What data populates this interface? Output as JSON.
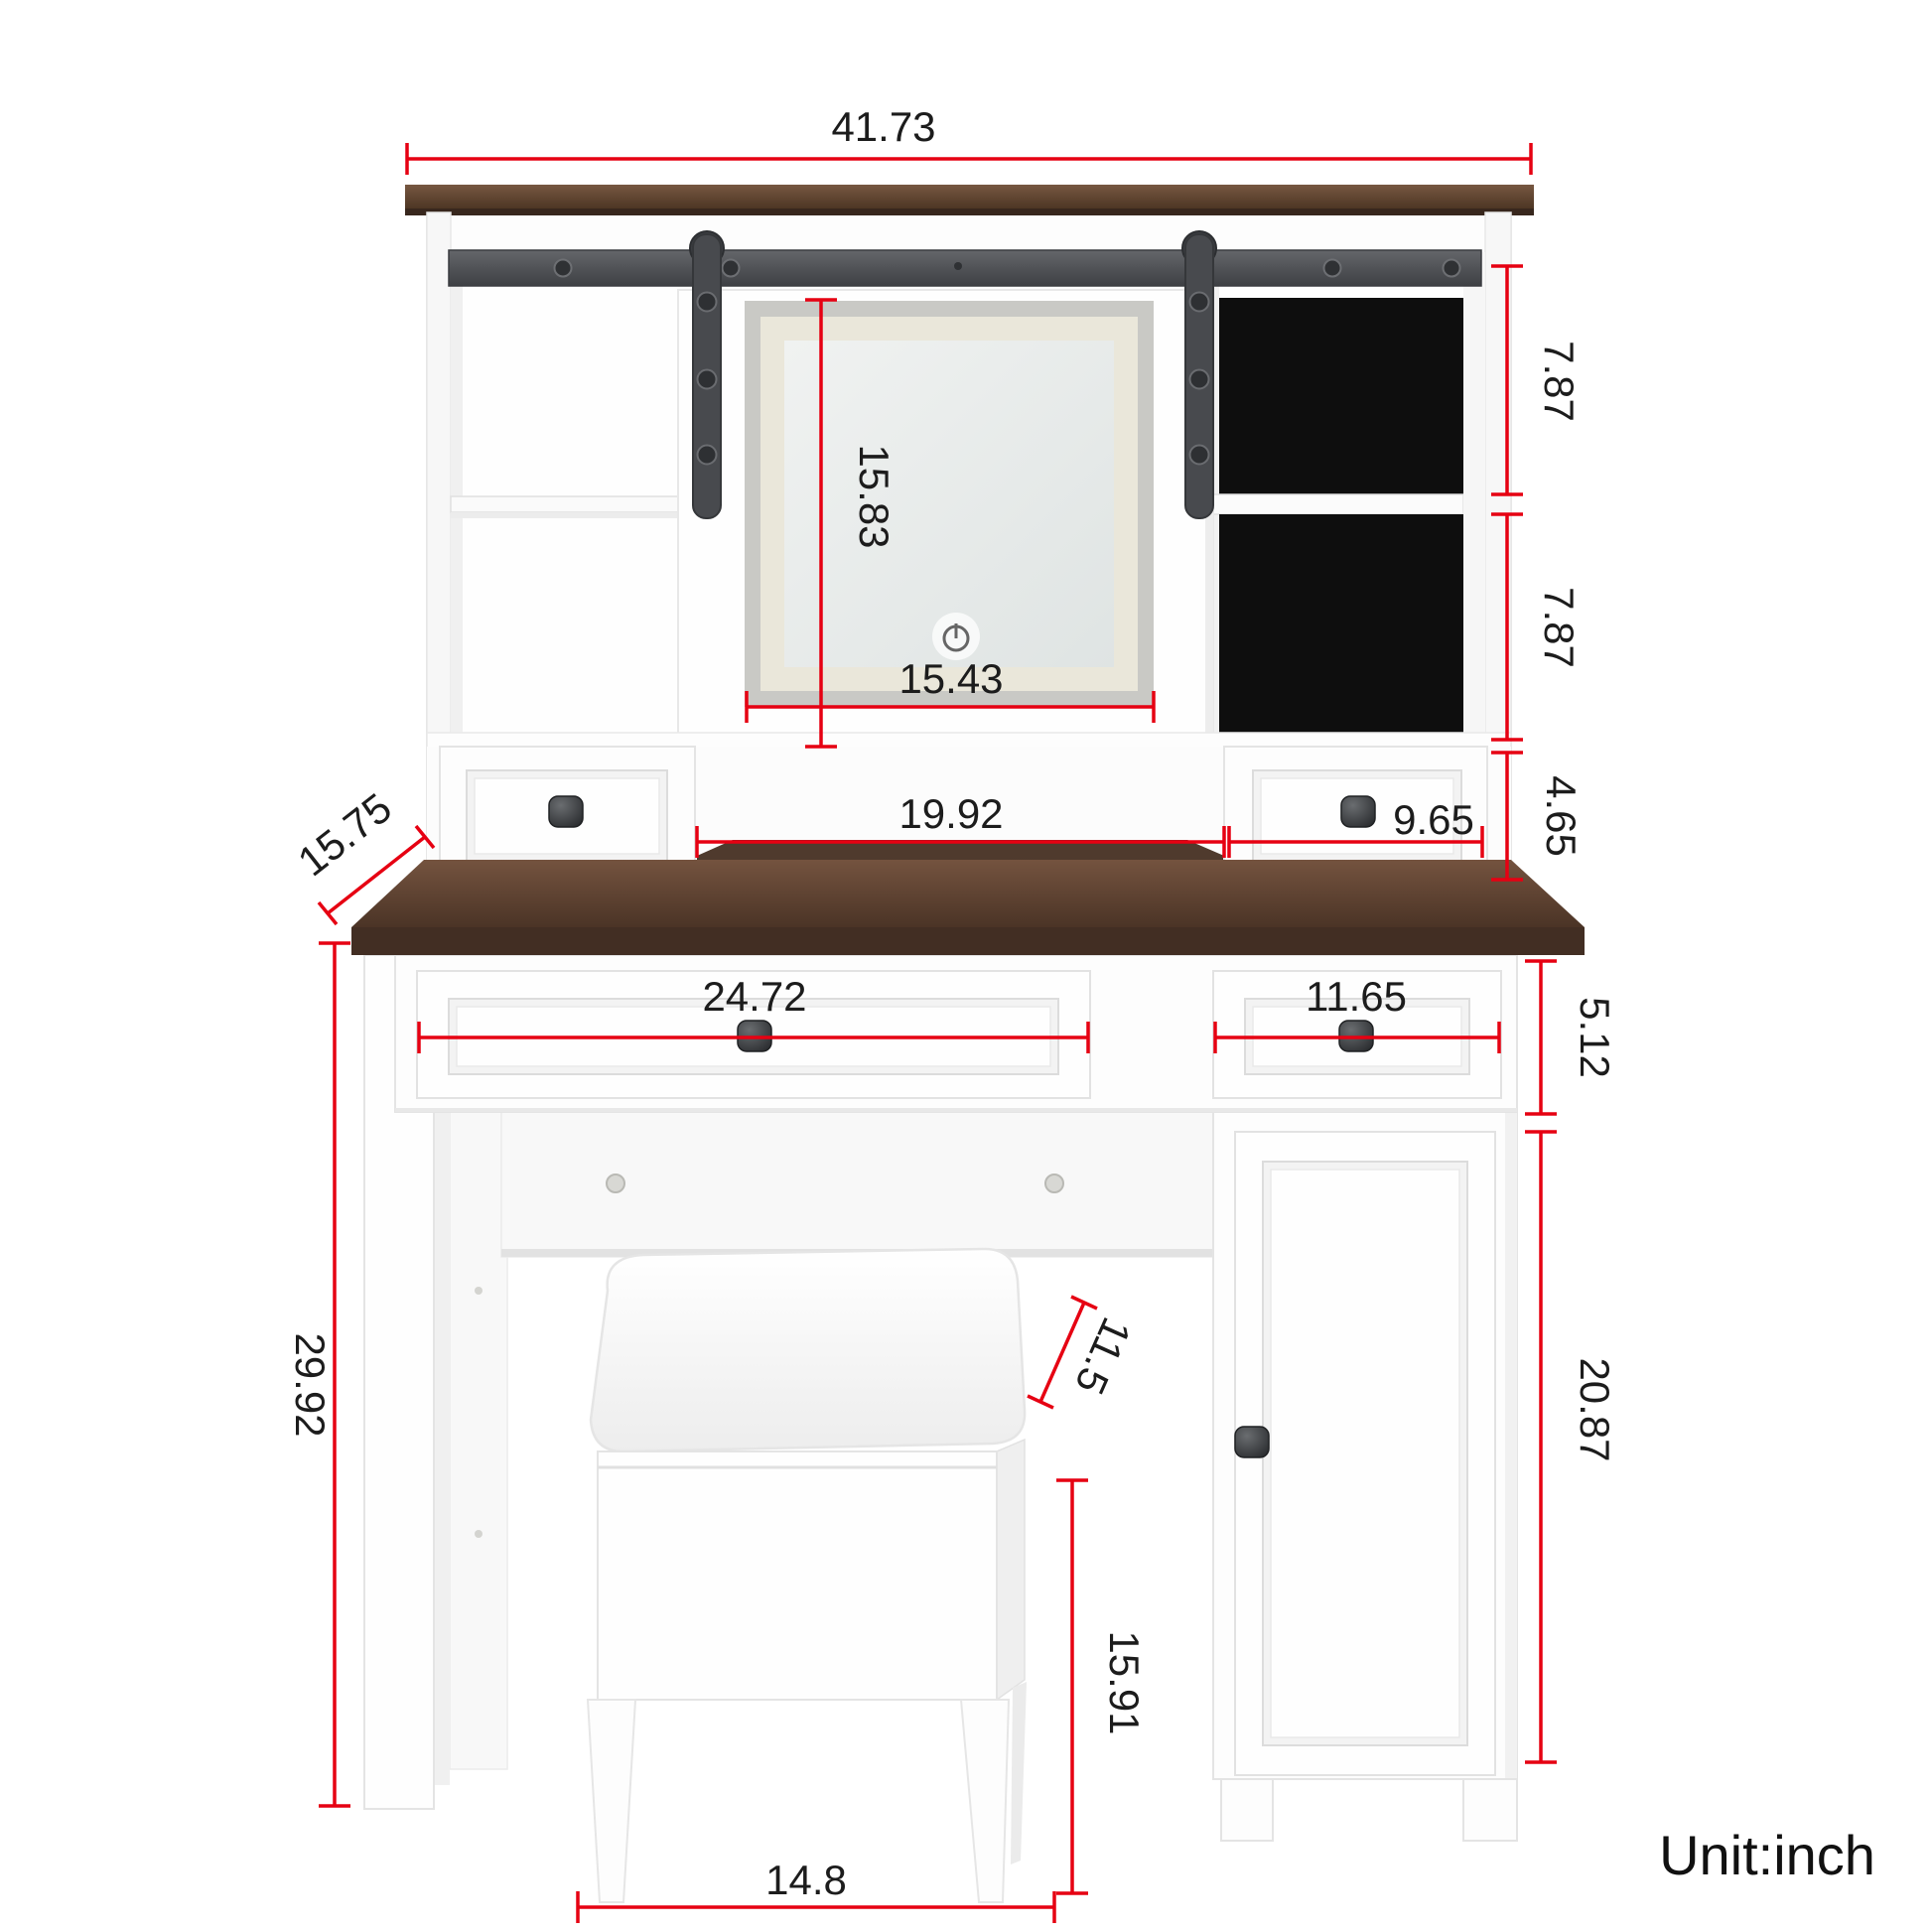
{
  "unit_label": "Unit:inch",
  "colors": {
    "dimension_red": "#e60012",
    "wood_brown": "#5a4030",
    "black_compartment": "#0e0e0e",
    "hardware_gray": "#4c4e52",
    "background": "#ffffff"
  },
  "icons": {
    "mirror_power": "power-icon"
  },
  "dimensions": {
    "hutch_width": "41.73",
    "mirror_height": "15.83",
    "mirror_width": "15.43",
    "right_cubby_top_height": "7.87",
    "right_cubby_bottom_height": "7.87",
    "hutch_drawer_height": "4.65",
    "hutch_open_width": "19.92",
    "hutch_drawer_width": "9.65",
    "desktop_depth": "15.75",
    "desk_drawer_left_width": "24.72",
    "desk_drawer_right_width": "11.65",
    "desk_drawer_height": "5.12",
    "desk_height": "29.92",
    "stool_depth": "11.5",
    "cabinet_door_height": "20.87",
    "stool_height": "15.91",
    "stool_width": "14.8"
  }
}
